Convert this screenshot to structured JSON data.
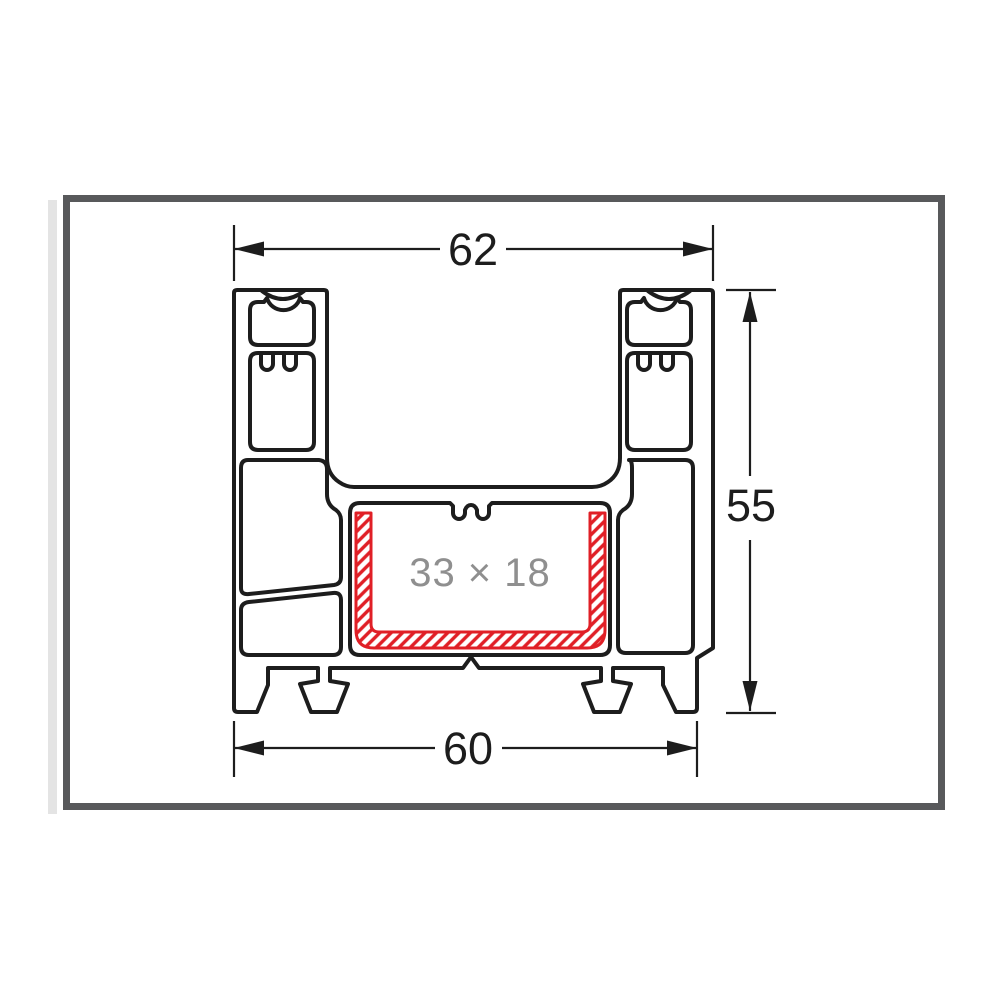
{
  "diagram": {
    "type": "technical cross-section drawing",
    "subject": "extruded window/door profile cross-section with highlighted reinforcement channel",
    "dimension_labels": {
      "top_width": "62",
      "side_height": "55",
      "bottom_width": "60",
      "inner_channel": "33 × 18"
    },
    "colors": {
      "outline": "#1d1d1d",
      "frame_border": "#58595b",
      "side_strip": "#e4e4e4",
      "highlight_red": "#e01f26",
      "channel_label_gray": "#8f8f8f",
      "background": "#ffffff"
    }
  }
}
